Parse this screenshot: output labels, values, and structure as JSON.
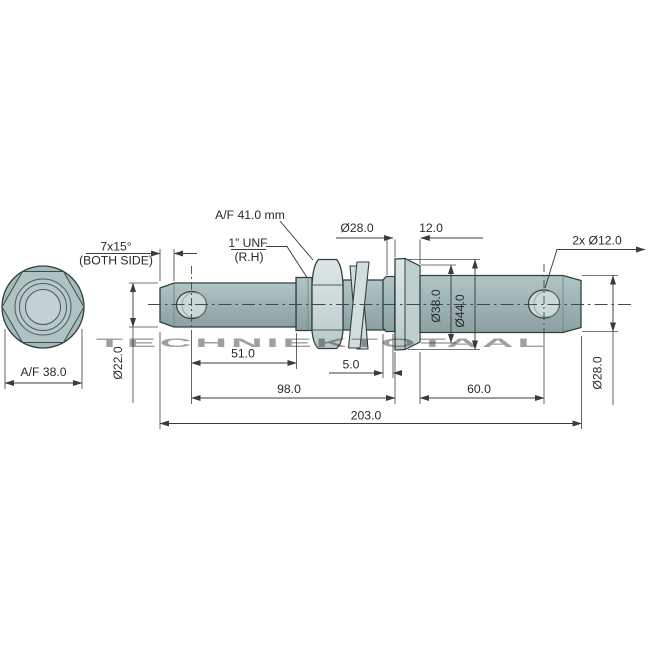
{
  "drawing_title": "Lower link implement pin technical drawing",
  "watermark": "TECHNIEKTOTAAL",
  "colors": {
    "body_teal": "#9fb5b5",
    "body_light": "#cdd9d9",
    "outline": "#32403f",
    "dimension_line": "#3c3c3c",
    "text": "#2a2a2a",
    "watermark": "#bcbcbc",
    "background": "#ffffff"
  },
  "end_view": {
    "af_label": "A/F 38.0"
  },
  "side_view": {
    "labels": {
      "chamfer_line1": "7x15°",
      "chamfer_line2": "(BOTH SIDE)",
      "af_nut": "A/F 41.0 mm",
      "thread_line1": "1” UNF",
      "thread_line2": "(R.H)",
      "dia28_top": "Ø28.0",
      "flange_width": "12.0",
      "holes": "2x Ø12.0",
      "dia22": "Ø22.0",
      "len51": "51.0",
      "len5": "5.0",
      "len98": "98.0",
      "len60": "60.0",
      "len203": "203.0",
      "dia38": "Ø38.0",
      "dia44": "Ø44.0",
      "dia28_right": "Ø28.0"
    }
  }
}
